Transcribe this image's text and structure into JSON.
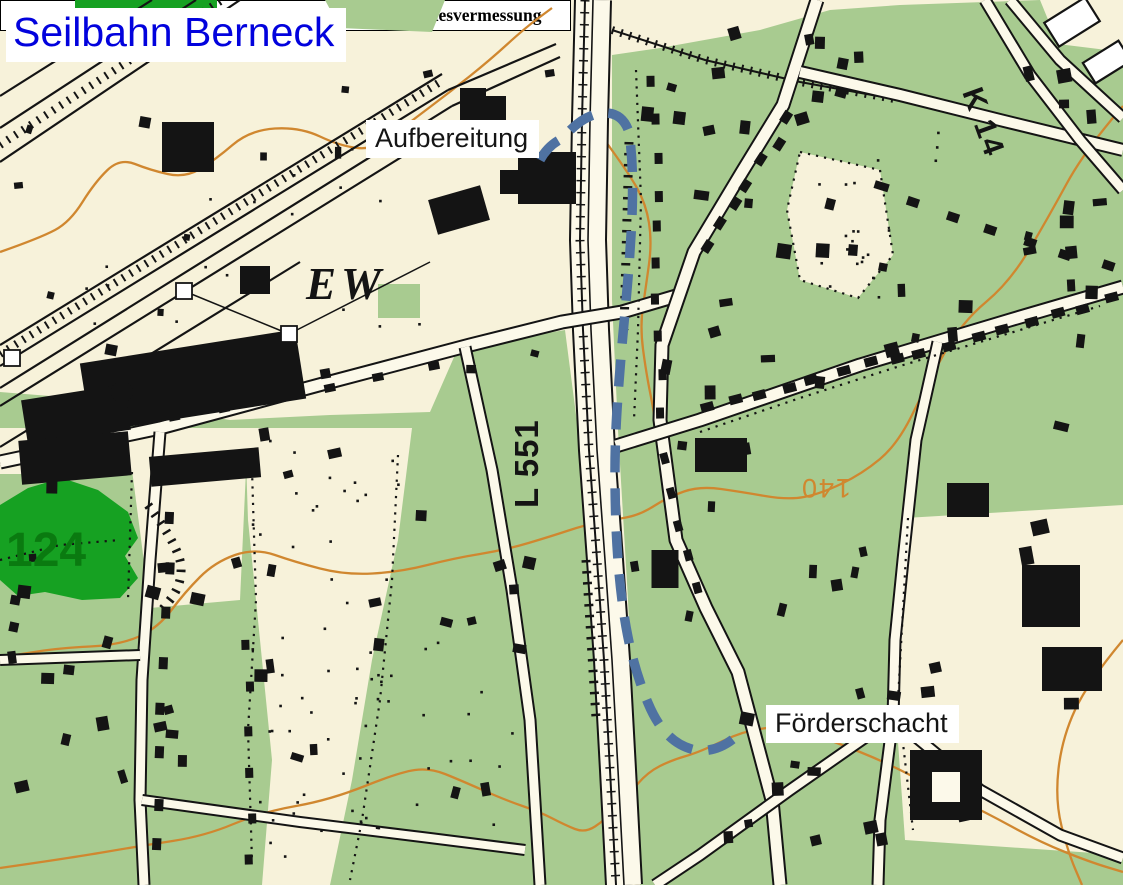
{
  "title": {
    "text": "Seilbahn Berneck",
    "color": "#0202dd"
  },
  "labels": {
    "aufbereitung": "Aufbereitung",
    "foerderschacht": "Förderschacht",
    "ew": "EW",
    "k14": "K 14",
    "l551": "L 551",
    "contour_140": "140",
    "forest_124": "124"
  },
  "attribution": "© Geobasisdaten und/oder Topographische Karten: Landesvermessung NRW, Bonn",
  "route": {
    "name": "Seilbahn route",
    "style": "dashed",
    "color": "#4f72a2"
  },
  "colors": {
    "paper": "#f7f2da",
    "vegetation": "#a8cb90",
    "forest": "#16a122",
    "contour": "#d0872f",
    "building": "#141414",
    "road_fill": "#fcf9ea",
    "ink": "#141414",
    "label_bg": "#ffffff"
  }
}
